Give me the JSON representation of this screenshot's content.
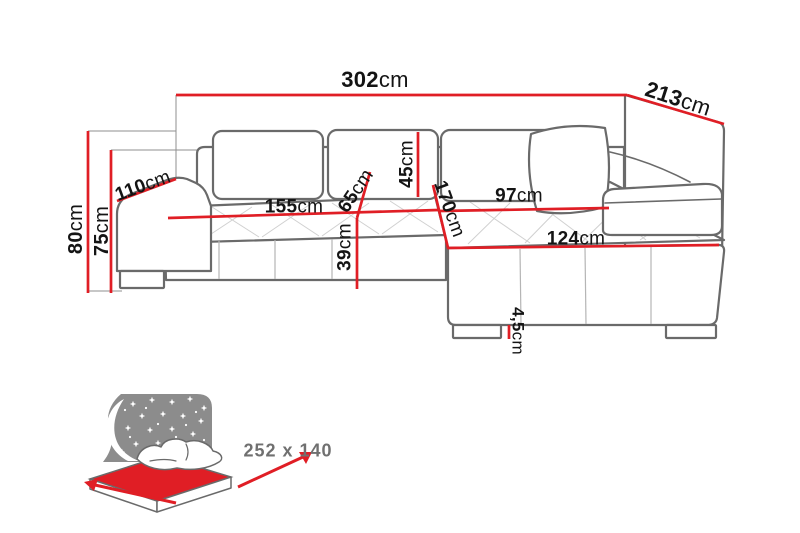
{
  "diagram": {
    "type": "corner-sofa dimension drawing",
    "unit": "cm",
    "dimensions": {
      "total_width": {
        "value": "302",
        "unit": "cm"
      },
      "total_depth": {
        "value": "213",
        "unit": "cm"
      },
      "armrest_depth": {
        "value": "110",
        "unit": "cm"
      },
      "total_height": {
        "value": "80",
        "unit": "cm"
      },
      "frame_height": {
        "value": "75",
        "unit": "cm"
      },
      "seat_width": {
        "value": "155",
        "unit": "cm"
      },
      "seat_depth": {
        "value": "65",
        "unit": "cm"
      },
      "backrest_height": {
        "value": "45",
        "unit": "cm"
      },
      "seat_height": {
        "value": "39",
        "unit": "cm"
      },
      "chaise_length": {
        "value": "170",
        "unit": "cm"
      },
      "chaise_seat_width": {
        "value": "97",
        "unit": "cm"
      },
      "chaise_width": {
        "value": "124",
        "unit": "cm"
      },
      "leg_height": {
        "value": "4,5",
        "unit": "cm"
      }
    },
    "sleeping_area": {
      "size_label": "252 x 140"
    },
    "colors": {
      "dimension_red": "#e01e25",
      "outline_gray": "#6a6a6a",
      "icon_gray": "#8c8c8c",
      "label_color": "#141414",
      "bed_text_gray": "#707070"
    }
  }
}
